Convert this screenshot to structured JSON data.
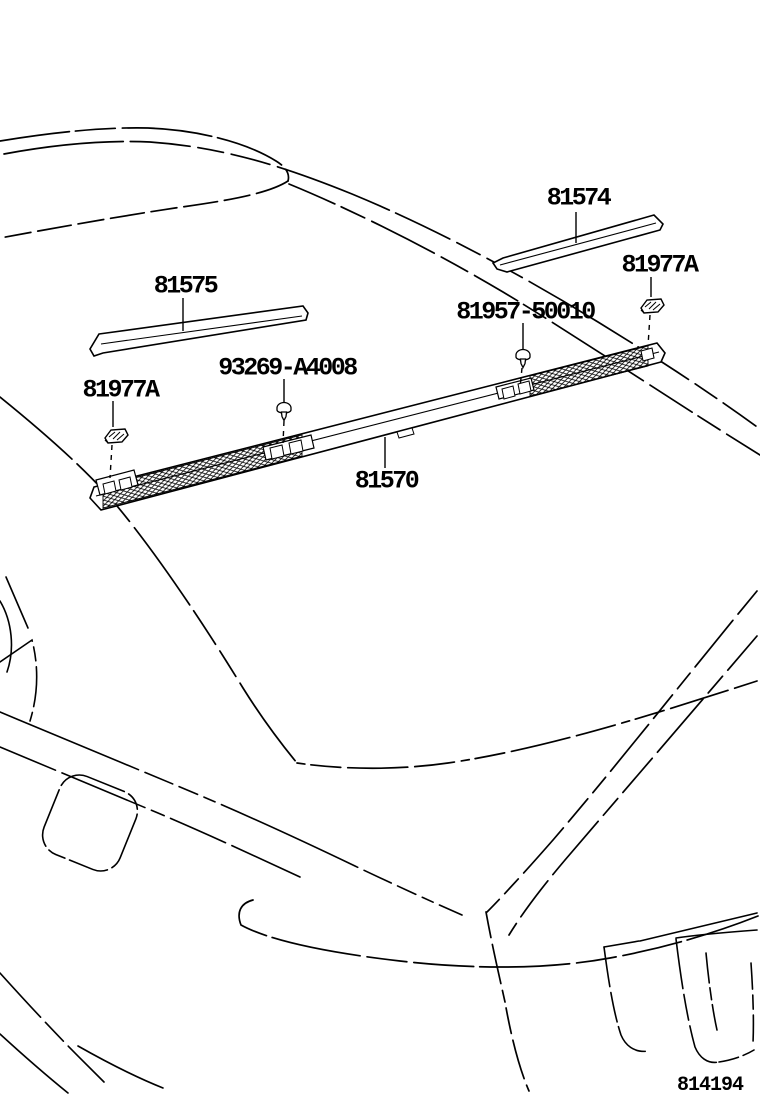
{
  "callouts": {
    "strip_rh": {
      "label": "81574"
    },
    "strip_lh": {
      "label": "81575"
    },
    "clip_left": {
      "label": "81977A"
    },
    "clip_right": {
      "label": "81977A"
    },
    "screw_1": {
      "label": "93269-A4008"
    },
    "screw_2": {
      "label": "81957-50010"
    },
    "lamp": {
      "label": "81570"
    }
  },
  "figure_number": "814194",
  "colors": {
    "line": "#000000",
    "background": "#ffffff"
  }
}
